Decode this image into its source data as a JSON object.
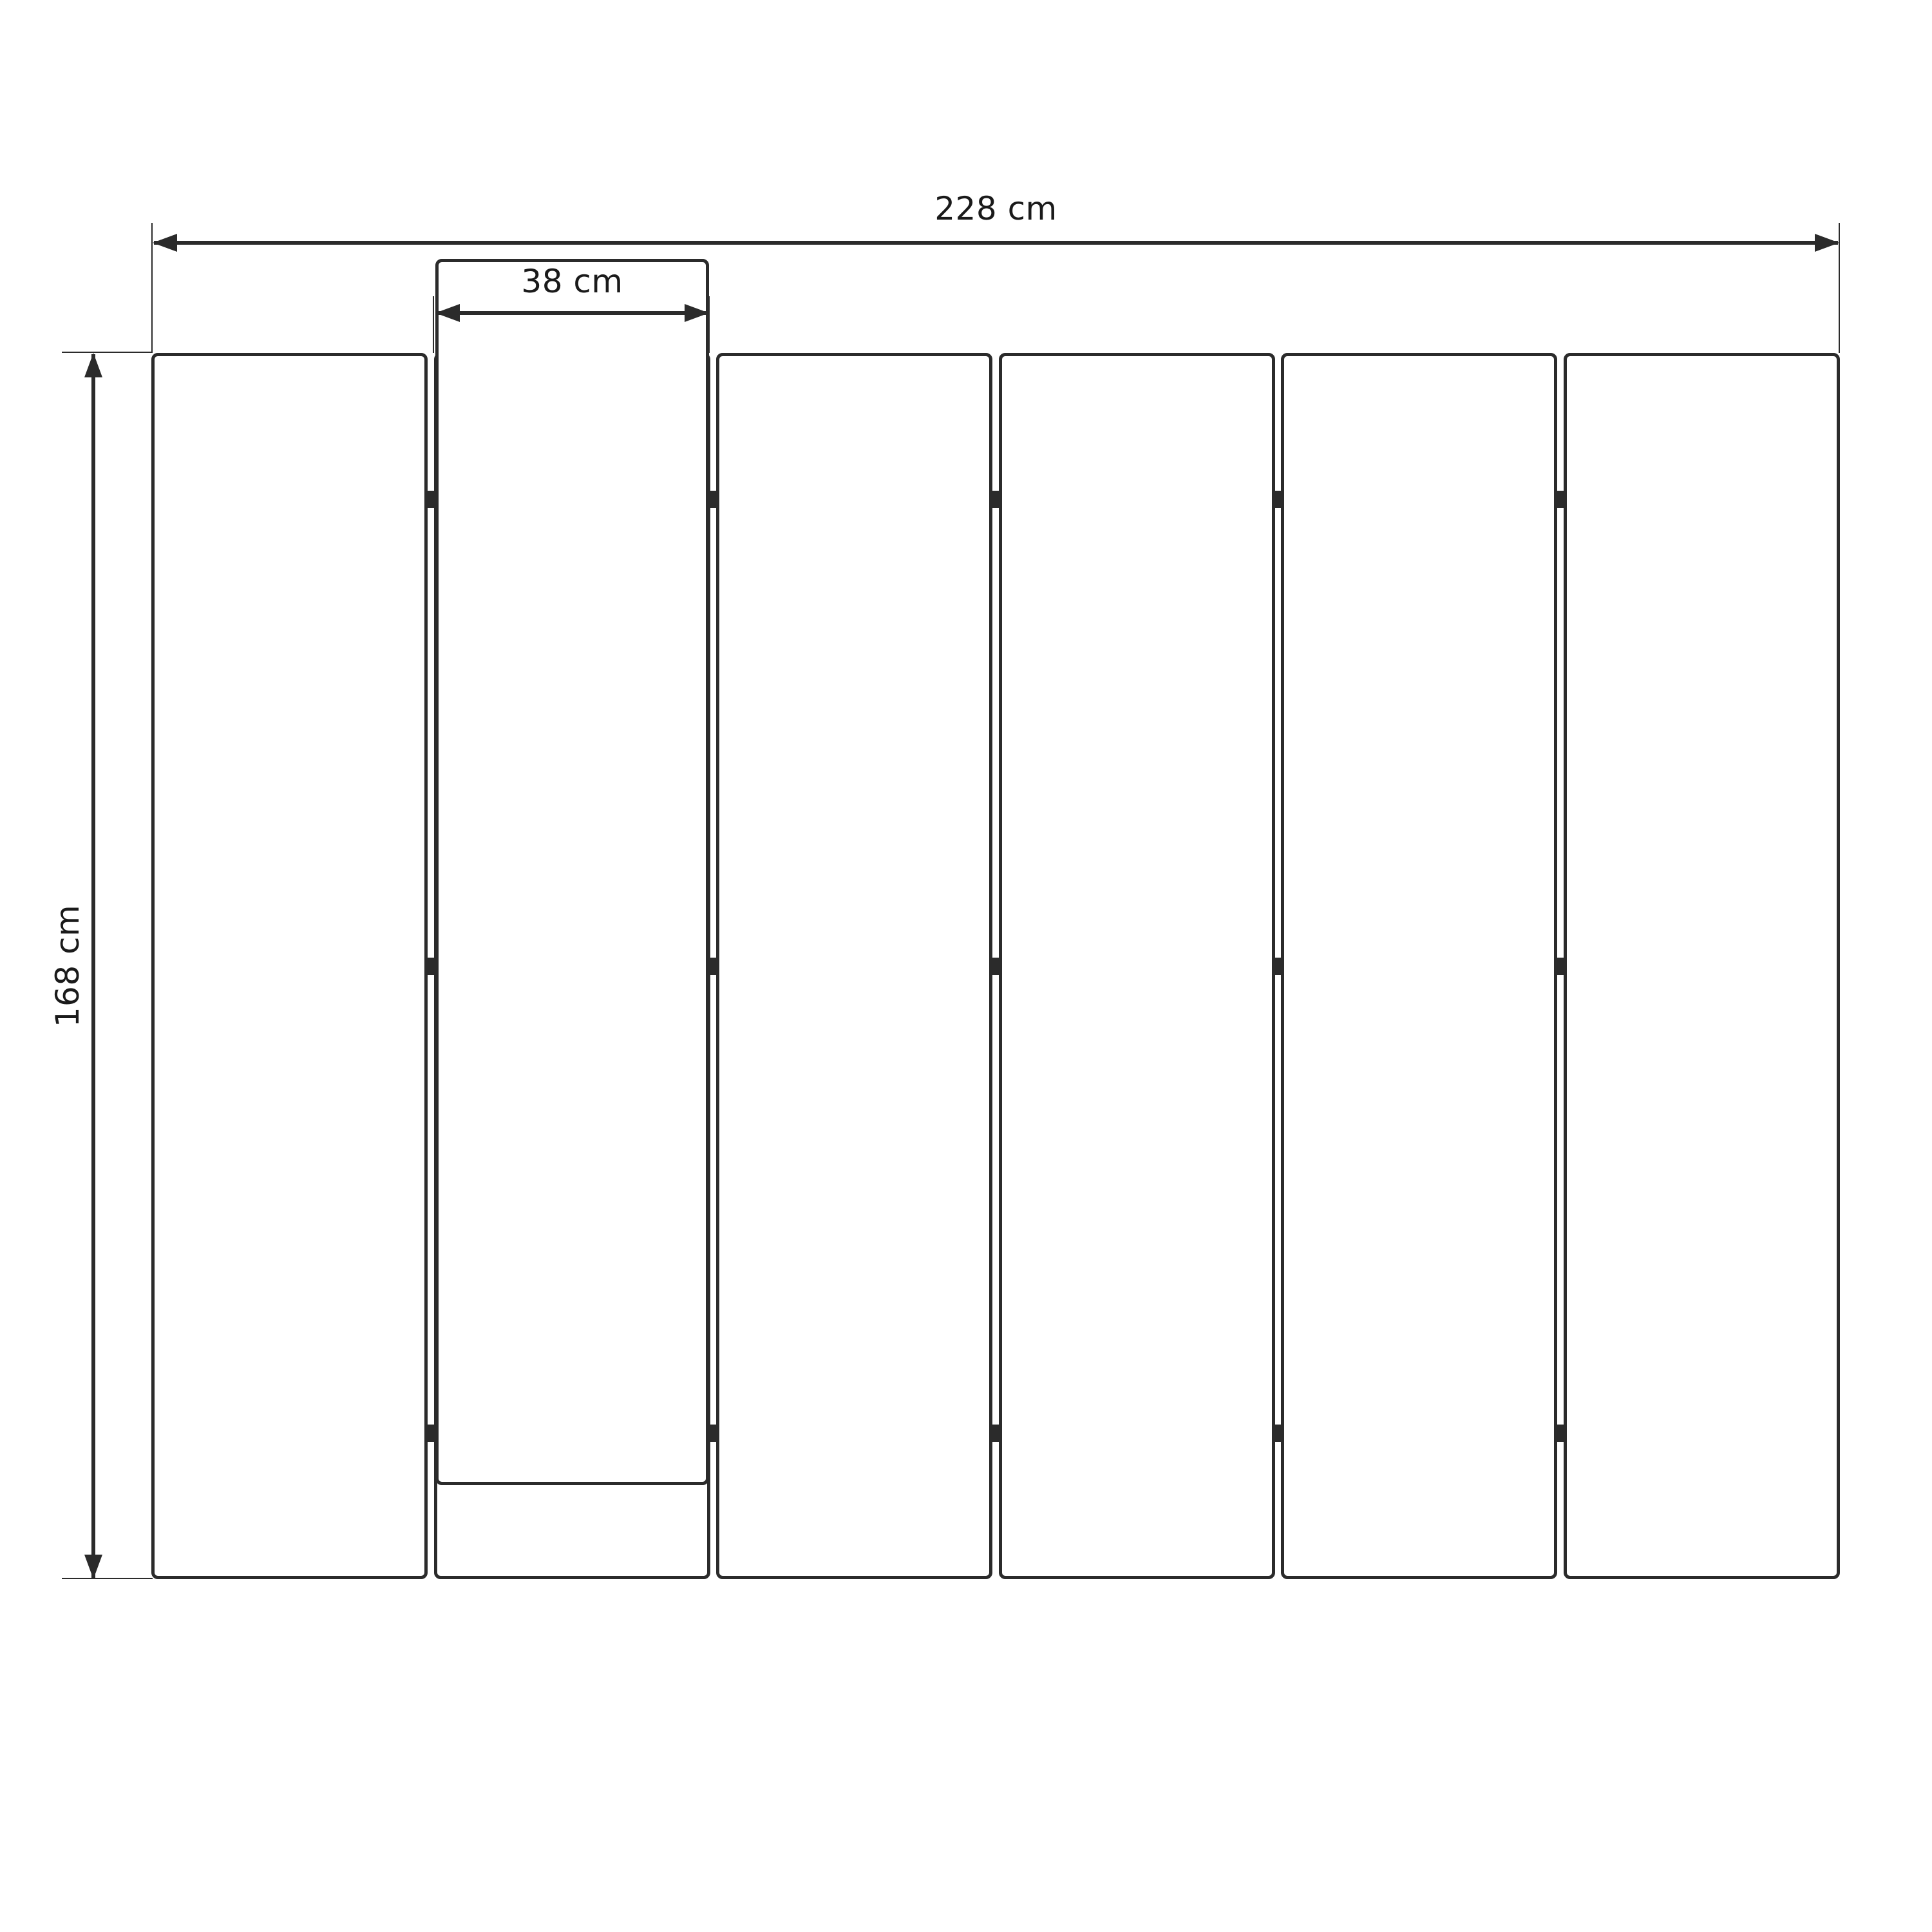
{
  "diagram": {
    "background": "#ffffff",
    "line_color": "#2b2b2b",
    "text_color": "#1a1a1a",
    "panels": {
      "count": 6,
      "hinge_columns": 5,
      "hinge_rows": 3
    },
    "dimensions": {
      "total_width": {
        "label": "228 cm"
      },
      "panel_width": {
        "label": "38 cm"
      },
      "height": {
        "label": "168 cm"
      }
    }
  }
}
